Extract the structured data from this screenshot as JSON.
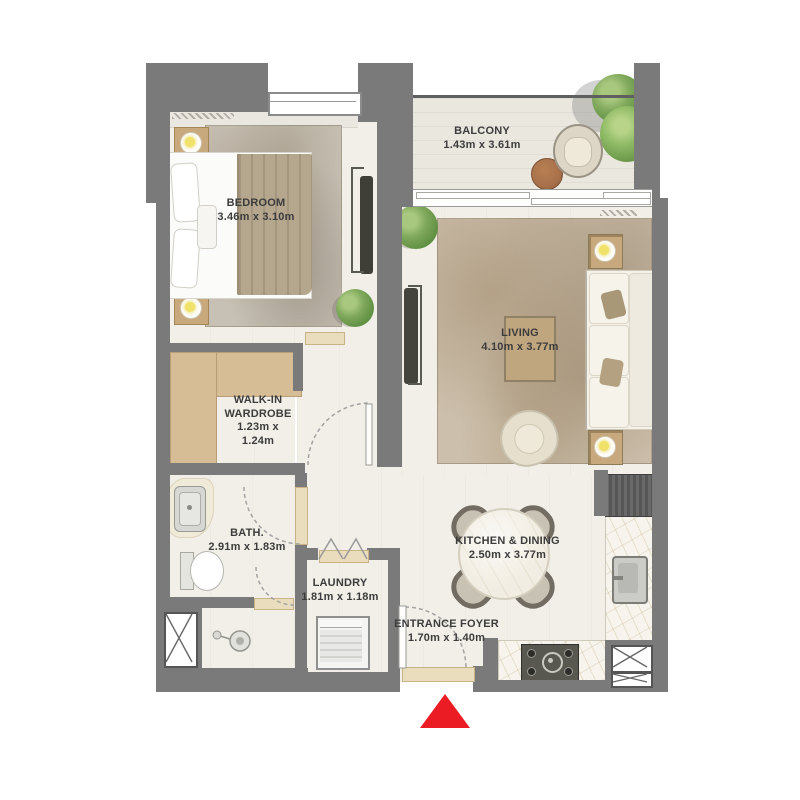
{
  "plan": {
    "title": "one-bedroom-apartment-floor-plan",
    "rooms": {
      "bedroom": {
        "name": "BEDROOM",
        "dimensions": "3.46m x 3.10m"
      },
      "balcony": {
        "name": "BALCONY",
        "dimensions": "1.43m x 3.61m"
      },
      "living": {
        "name": "LIVING",
        "dimensions": "4.10m x 3.77m"
      },
      "walk_in_wardrobe": {
        "name_line1": "WALK-IN",
        "name_line2": "WARDROBE",
        "dimensions_line1": "1.23m x",
        "dimensions_line2": "1.24m"
      },
      "bath": {
        "name": "BATH.",
        "dimensions": "2.91m x 1.83m"
      },
      "laundry": {
        "name": "LAUNDRY",
        "dimensions": "1.81m x 1.18m"
      },
      "kitchen_dining": {
        "name": "KITCHEN & DINING",
        "dimensions": "2.50m x 3.77m"
      },
      "entrance_foyer": {
        "name": "ENTRANCE FOYER",
        "dimensions": "1.70m x 1.40m"
      }
    },
    "entrance_marker": {
      "shape": "triangle-up",
      "color": "#ec1c24"
    },
    "colors": {
      "wall": "#7a7a7a",
      "floor": "#f2efe8",
      "rug": "#c9bcaa",
      "wardrobe": "#d7bd95",
      "label_text": "#3c3c3c",
      "entrance_marker": "#ec1c24",
      "lamp": "#f0e168",
      "plant": "#7ba557",
      "marble": "#f7f4ed",
      "threshold": "#e9ddbe"
    },
    "furniture_icons": [
      "bed",
      "nightstand-lamp",
      "tv-console",
      "wardrobe-unit",
      "sofa",
      "side-table-lamp",
      "coffee-table",
      "armchair",
      "dining-table",
      "dining-chair",
      "washing-machine",
      "toilet",
      "vanity-sink",
      "shower-head",
      "fridge",
      "kitchen-sink",
      "stove",
      "balcony-chair",
      "balcony-table",
      "plant",
      "service-shaft",
      "door-arc",
      "window"
    ]
  }
}
